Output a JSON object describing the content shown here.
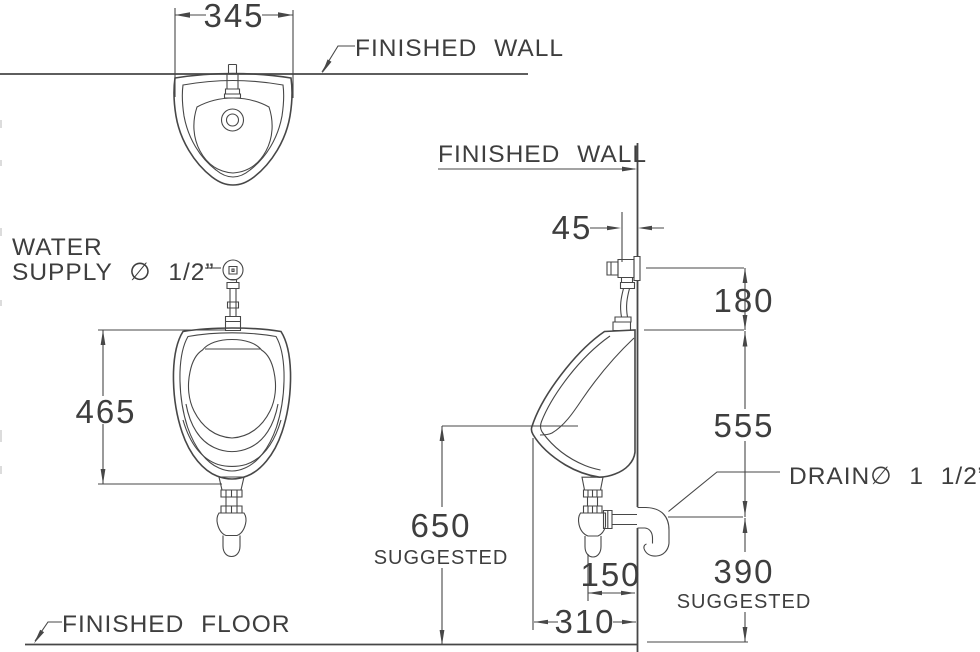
{
  "page": {
    "background": "#ffffff",
    "line_color": "#474747",
    "text_color": "#3e3e3e"
  },
  "labels": {
    "finished_wall_top": "FINISHED WALL",
    "finished_wall_side": "FINISHED WALL",
    "finished_floor": "FINISHED FLOOR",
    "water_supply_line1": "WATER",
    "water_supply_line2": "SUPPLY ∅ 1/2”",
    "drain": "DRAIN∅ 1 1/2”"
  },
  "dimensions": {
    "plan_width": "345",
    "front_height": "465",
    "rim_height": "650",
    "rim_height_note": "SUGGESTED",
    "supply_to_wall": "45",
    "valve_span": "180",
    "top_to_drain": "555",
    "drain_to_wall": "150",
    "depth": "310",
    "drain_height": "390",
    "drain_height_note": "SUGGESTED"
  }
}
